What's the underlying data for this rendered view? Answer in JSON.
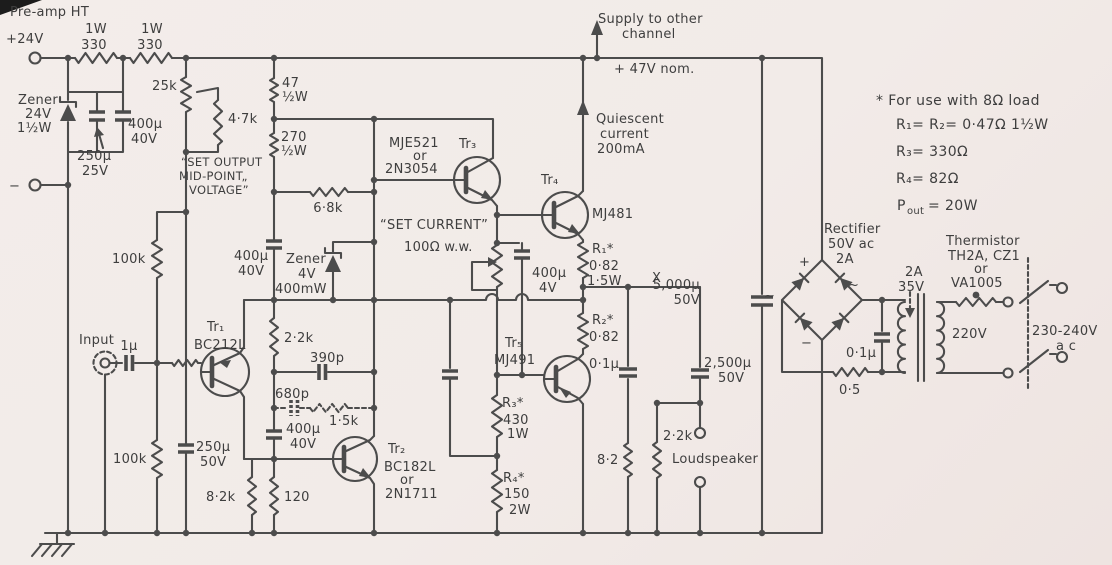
{
  "canvas": {
    "background": "#f2ebe8",
    "ink": "#4c4c4c",
    "text": "#3e3e3e"
  },
  "labels": {
    "preamp_ht": "Pre-amp HT",
    "v_plus": "+24V",
    "v_minus": "−",
    "r330a": [
      "1W",
      "330"
    ],
    "r330b": [
      "1W",
      "330"
    ],
    "zener24": [
      "Zener",
      "24V",
      "1½W"
    ],
    "c250_25": [
      "250μ",
      "25V"
    ],
    "c400_a": [
      "400μ",
      "40V"
    ],
    "pot25k": "25k",
    "r4k7": "4·7k",
    "preset_note": [
      "“SET OUTPUT",
      "MID-POINT„",
      "VOLTAGE”"
    ],
    "r47": [
      "47",
      "½W"
    ],
    "r270": [
      "270",
      "½W"
    ],
    "r6k8": "6·8k",
    "c400_b": [
      "400μ",
      "40V"
    ],
    "zener4": [
      "Zener",
      "4V",
      "400mW"
    ],
    "r2k2": "2·2k",
    "c390": "390p",
    "c680": "680p",
    "r1k5": "1·5k",
    "r100k_top": "100k",
    "r100k_bot": "100k",
    "input": "Input",
    "c1u": "1μ",
    "tr1": "Tr₁",
    "tr1_type": "BC212L",
    "c250_50": [
      "250μ",
      "50V"
    ],
    "r8k2": "8·2k",
    "r120": "120",
    "c400_c": [
      "400μ",
      "40V"
    ],
    "tr2": "Tr₂",
    "tr2_type": [
      "BC182L",
      "or",
      "2N1711"
    ],
    "tr3": "Tr₃",
    "tr3_type": [
      "MJE521",
      "or",
      "2N3054"
    ],
    "set_current": "“SET CURRENT”",
    "pot100": "100Ω w.w.",
    "c400_4v": [
      "400μ",
      "4V"
    ],
    "tr4": "Tr₄",
    "tr4_type": "MJ481",
    "supply_other": [
      "Supply to other",
      "channel"
    ],
    "rail": "+ 47V nom.",
    "quiescent": [
      "Quiescent",
      "current",
      "200mA"
    ],
    "r1": [
      "R₁*",
      "0·82",
      "1·5W"
    ],
    "r2": [
      "R₂*",
      "0·82"
    ],
    "x_point": "X",
    "tr5": "Tr₅",
    "tr5_type": "MJ491",
    "r3": [
      "R₃*",
      "430",
      "1W"
    ],
    "r4": [
      "R₄*",
      "150",
      "2W"
    ],
    "c01_out": "0·1μ",
    "r8r2": "8·2",
    "c2500": [
      "2,500μ",
      "50V"
    ],
    "r2k2_ls": "2·2k",
    "loudspeaker": "Loudspeaker",
    "c5000": [
      "5,000μ",
      "50V"
    ],
    "rectifier": [
      "Rectifier",
      "50V ac",
      "2A"
    ],
    "plus": "+",
    "minus": "−",
    "ac_left": "~",
    "ac_right": "~",
    "r05": "0·5",
    "c01_mains": "0·1μ",
    "secondary": [
      "2A",
      "35V"
    ],
    "thermistor": [
      "Thermistor",
      "TH2A, CZ1",
      "or",
      "VA1005"
    ],
    "v220": "220V",
    "mains": [
      "230-240V",
      "a c"
    ],
    "notes": {
      "l1": "* For use with 8Ω load",
      "l2": "R₁= R₂= 0·47Ω 1½W",
      "l3": "R₃= 330Ω",
      "l4": "R₄= 82Ω",
      "p": "P",
      "p_sub": "out",
      "p_eq": "= 20W"
    }
  }
}
